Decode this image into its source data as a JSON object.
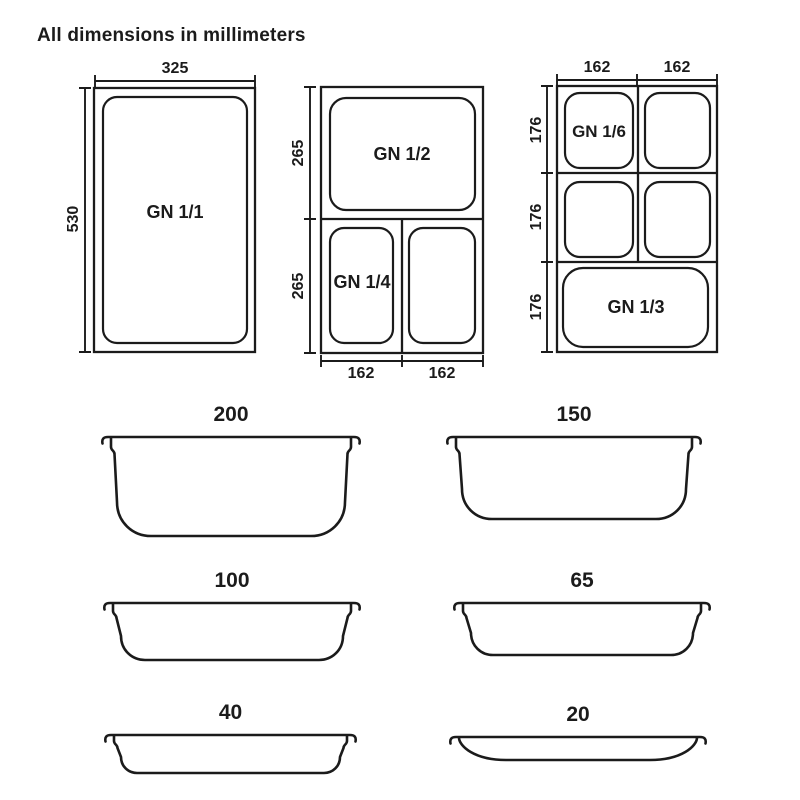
{
  "title": "All dimensions in millimeters",
  "colors": {
    "ink": "#1b1b1b",
    "background": "#ffffff"
  },
  "plan_views": {
    "gn11": {
      "label": "GN 1/1",
      "width_mm": "325",
      "height_mm": "530"
    },
    "gn12_gn14": {
      "gn12_label": "GN 1/2",
      "gn14_label": "GN 1/4",
      "height_top_mm": "265",
      "height_bottom_mm": "265",
      "width_left_mm": "162",
      "width_right_mm": "162"
    },
    "gn16_gn13": {
      "gn16_label": "GN 1/6",
      "gn13_label": "GN 1/3",
      "width_left_mm": "162",
      "width_right_mm": "162",
      "height_row1_mm": "176",
      "height_row2_mm": "176",
      "height_row3_mm": "176"
    }
  },
  "depth_profiles": [
    {
      "depth_mm": "200"
    },
    {
      "depth_mm": "150"
    },
    {
      "depth_mm": "100"
    },
    {
      "depth_mm": "65"
    },
    {
      "depth_mm": "40"
    },
    {
      "depth_mm": "20"
    }
  ]
}
